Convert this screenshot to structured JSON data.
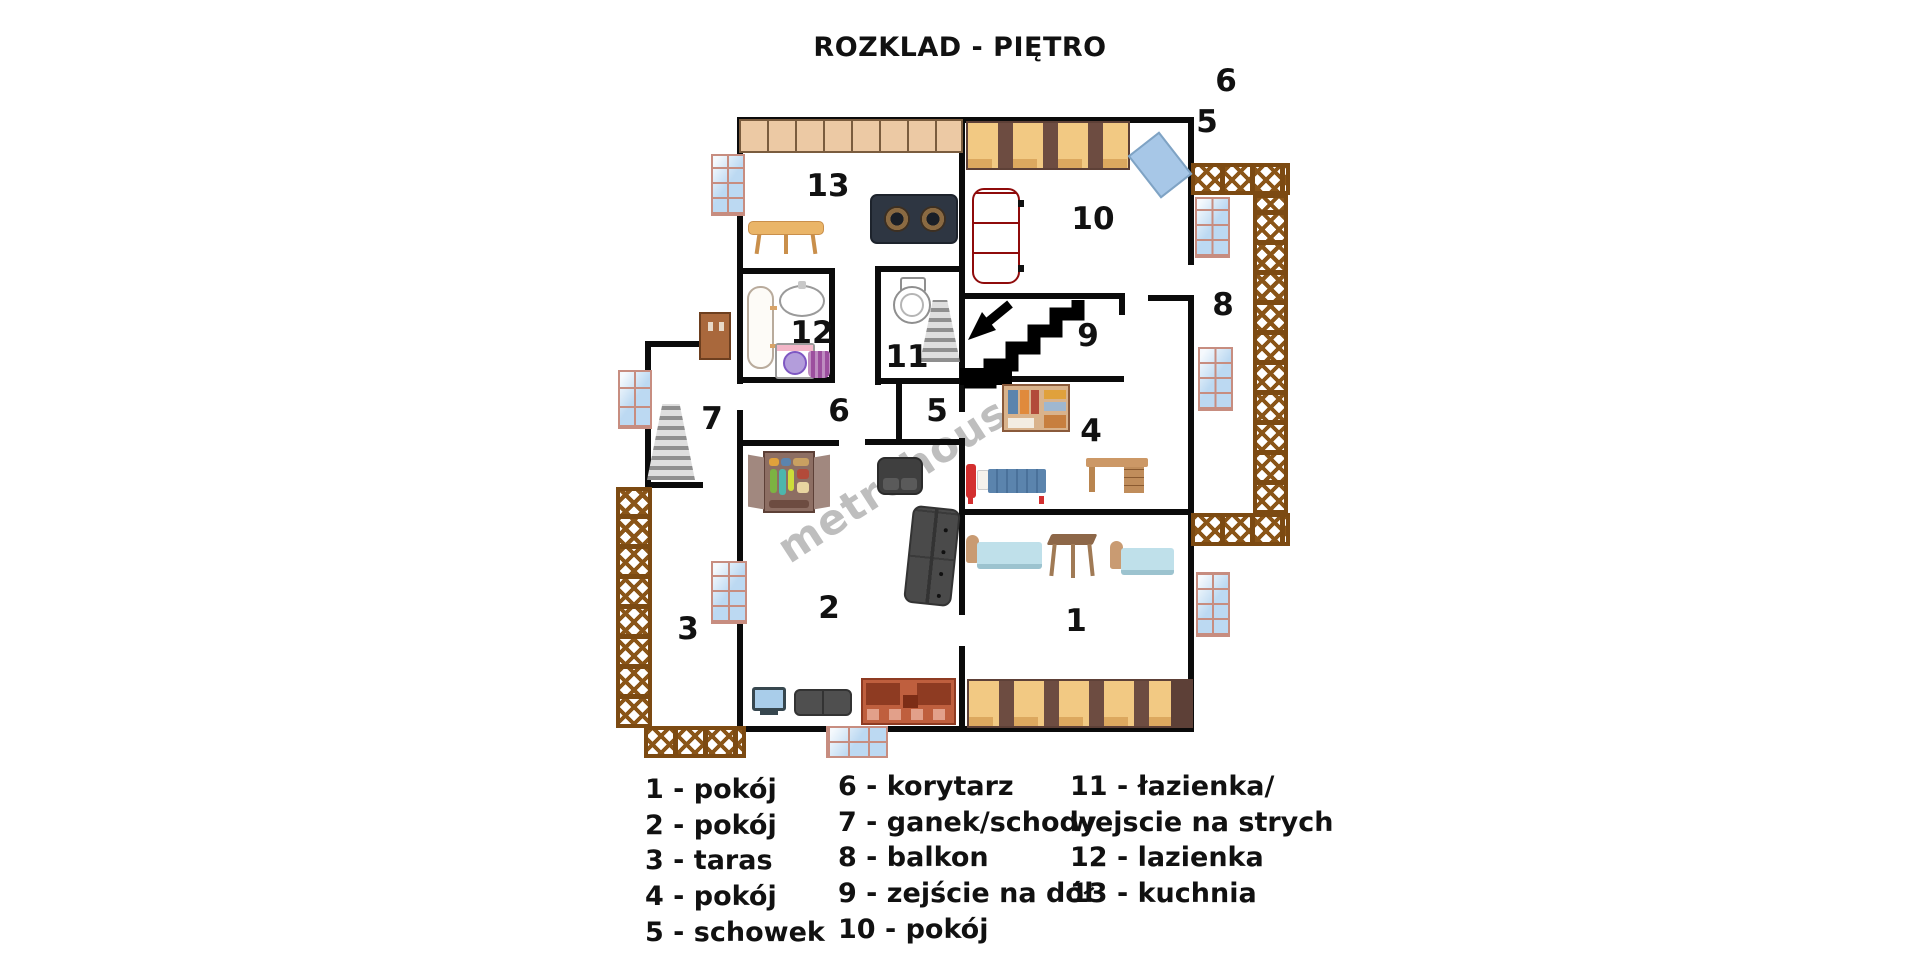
{
  "title": "ROZKLAD - PIĘTRO",
  "watermark": "metrohouse",
  "rooms": {
    "n1": "1",
    "n2": "2",
    "n3": "3",
    "n4": "4",
    "n5": "5",
    "n6": "6",
    "n7": "7",
    "n8": "8",
    "n9": "9",
    "n10": "10",
    "n11": "11",
    "n12": "12",
    "n13": "13",
    "ext5": "5",
    "ext6": "6"
  },
  "legend": {
    "col1": [
      "1 -  pokój",
      "2 - pokój",
      "3 - taras",
      "4 - pokój",
      "5 - schowek"
    ],
    "col2": [
      "6 - korytarz",
      "7 - ganek/schody",
      "8 - balkon",
      "9 - zejście na dół",
      "10 - pokój"
    ],
    "col3": [
      "11 - łazienka/",
      "wejscie na strych",
      "12 - lazienka",
      "13 - kuchnia"
    ]
  },
  "colors": {
    "wall": "#0b0b0b",
    "truss_brown": "#7c4a12",
    "window_pane": "#bcd9f2",
    "window_frame": "#c78d80",
    "cabinet_tan": "#ecc9a4",
    "wardrobe_gold": "#f2c983",
    "sofa_red": "#e01414",
    "stairs_black": "#000000"
  }
}
